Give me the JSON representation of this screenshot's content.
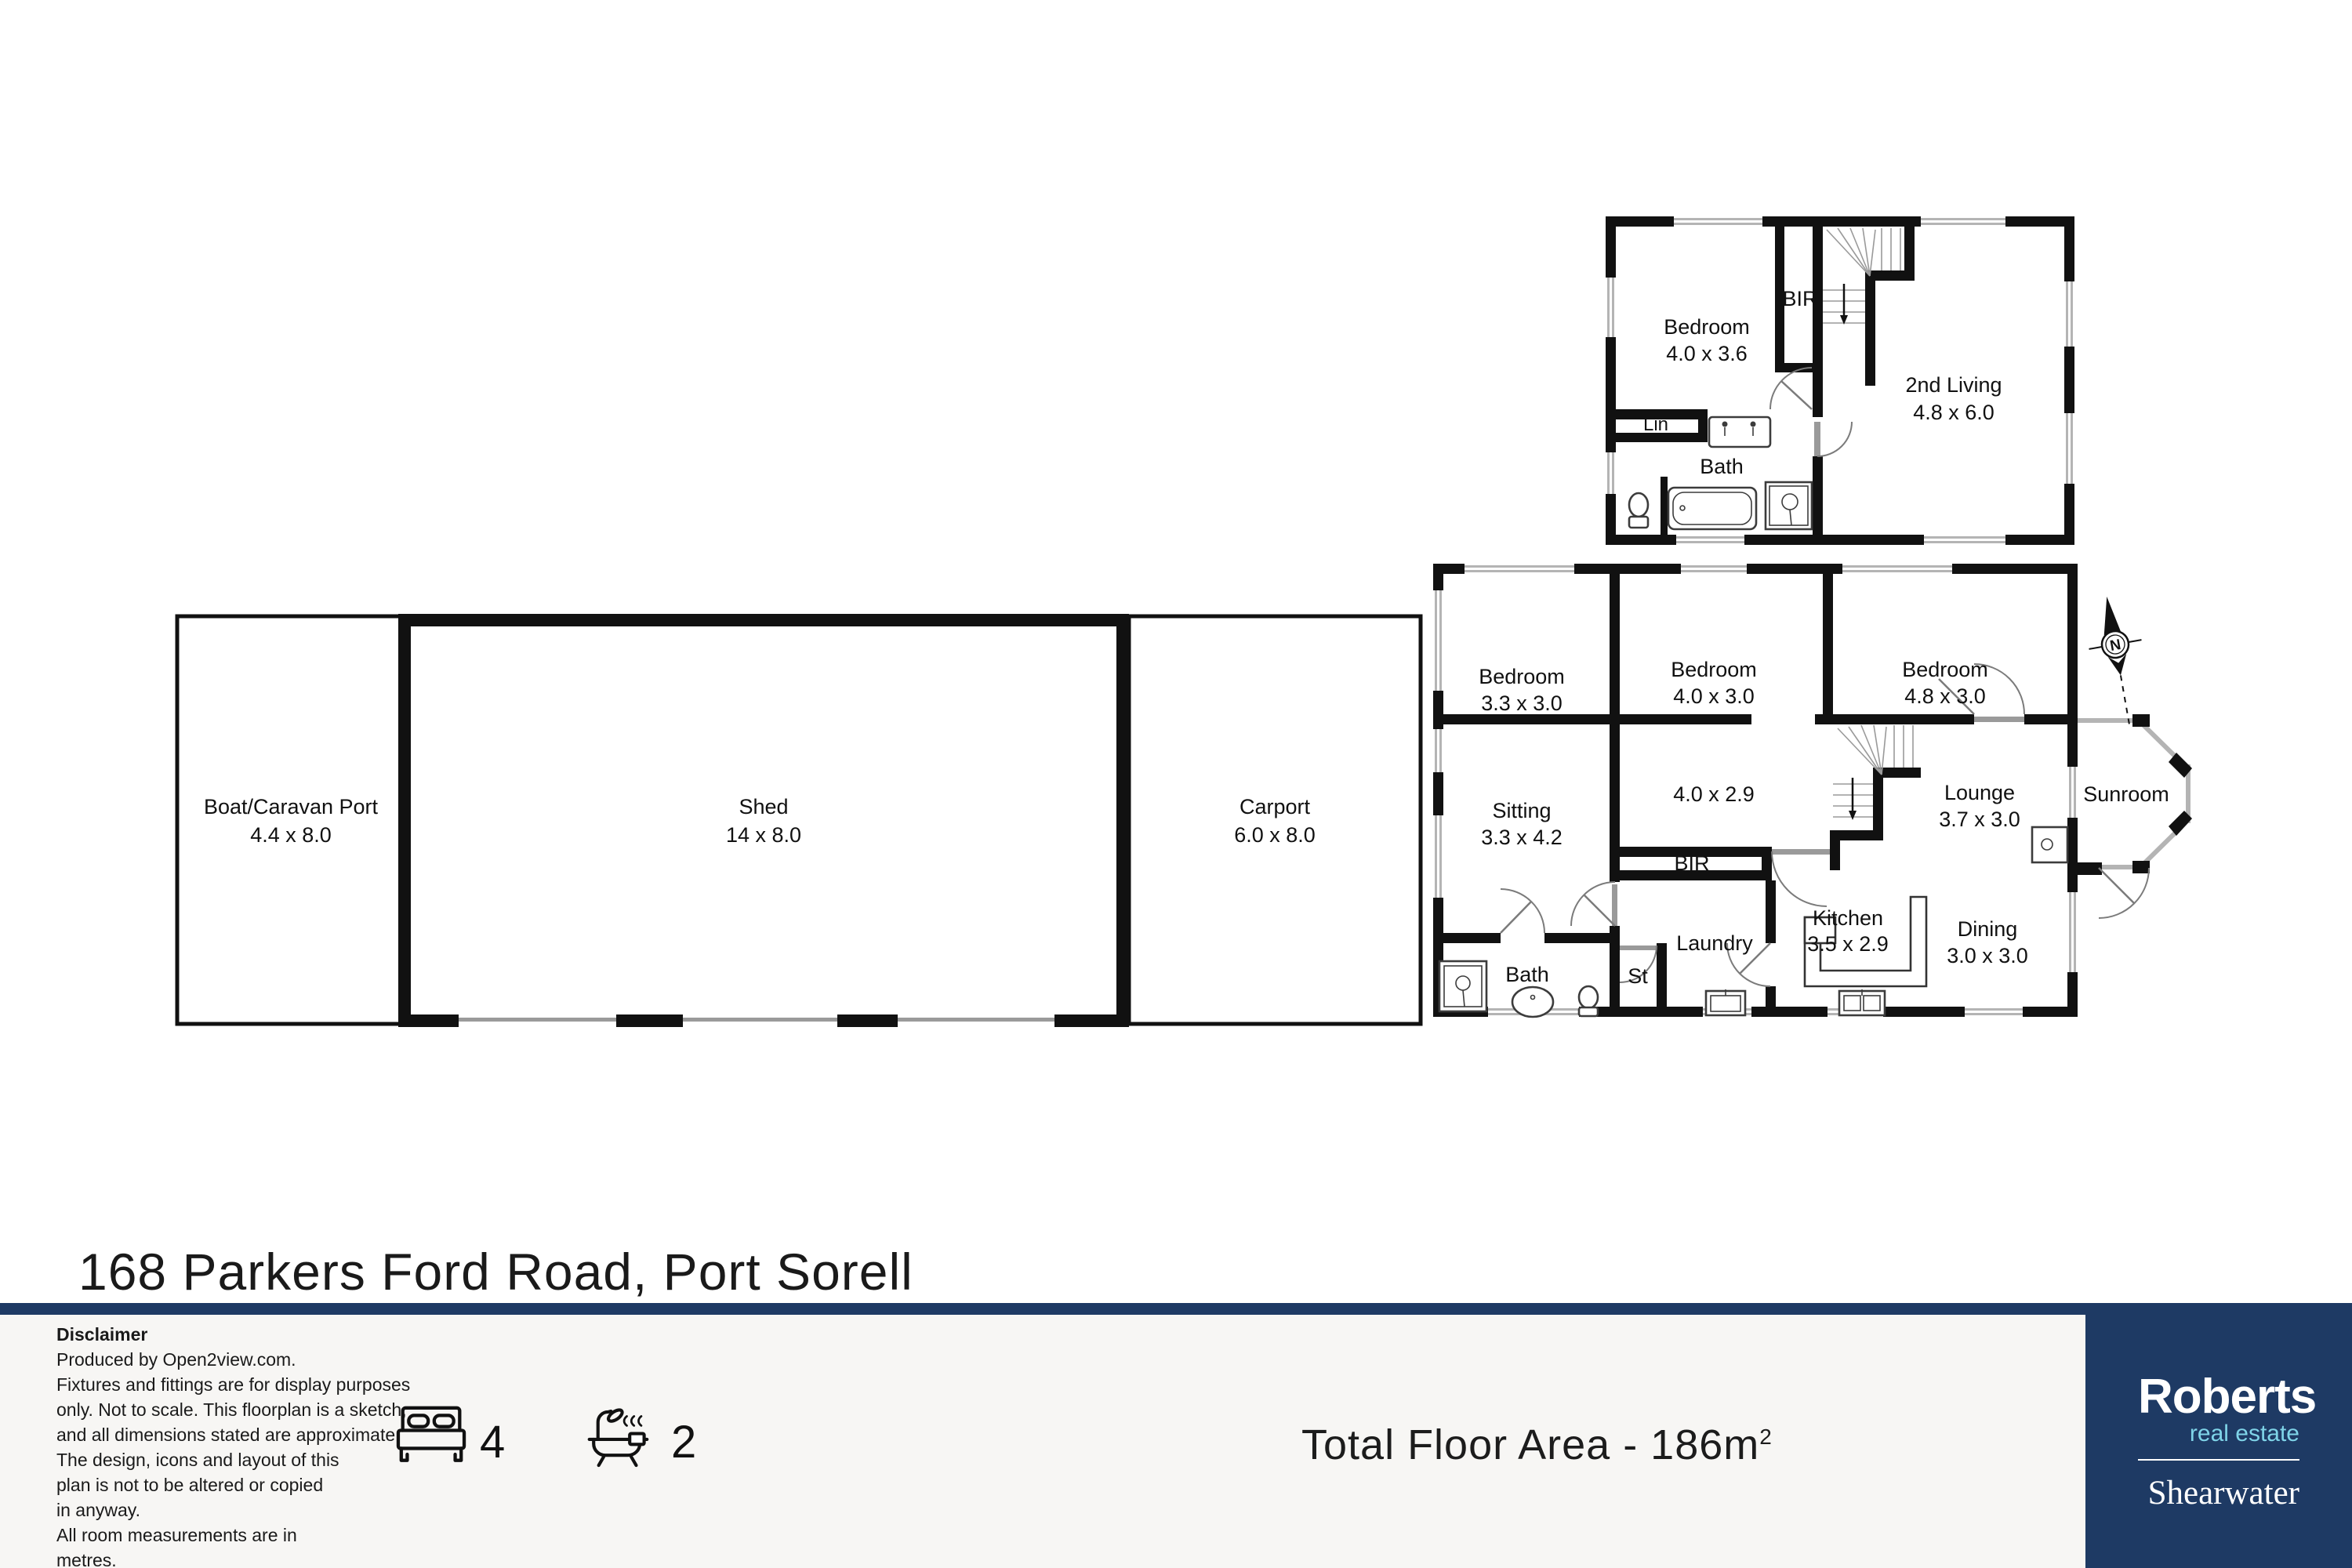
{
  "title": "168 Parkers Ford Road, Port Sorell",
  "plan": {
    "boat_name": "Boat/Caravan Port",
    "boat_dims": "4.4 x 8.0",
    "shed_name": "Shed",
    "shed_dims": "14 x 8.0",
    "carport_name": "Carport",
    "carport_dims": "6.0 x 8.0",
    "up_bedroom_name": "Bedroom",
    "up_bedroom_dims": "4.0 x 3.6",
    "up_bir": "BIR",
    "up_living_name": "2nd Living",
    "up_living_dims": "4.8 x 6.0",
    "up_lin": "Lin",
    "up_bath": "Bath",
    "g_bed1_name": "Bedroom",
    "g_bed1_dims": "3.3 x 3.0",
    "g_bed2_name": "Bedroom",
    "g_bed2_dims": "4.0 x 3.0",
    "g_bed3_name": "Bedroom",
    "g_bed3_dims": "4.8 x 3.0",
    "g_sitting_name": "Sitting",
    "g_sitting_dims": "3.3 x 4.2",
    "g_hall_dims": "4.0 x 2.9",
    "g_bir": "BIR",
    "g_lounge_name": "Lounge",
    "g_lounge_dims": "3.7 x 3.0",
    "g_sunroom": "Sunroom",
    "g_kitchen_name": "Kitchen",
    "g_kitchen_dims": "3.5 x 2.9",
    "g_dining_name": "Dining",
    "g_dining_dims": "3.0 x 3.0",
    "g_laundry": "Laundry",
    "g_bath": "Bath",
    "g_st": "St",
    "compass": "N"
  },
  "footer": {
    "disclaimer_heading": "Disclaimer",
    "disclaimer_lines": [
      "Produced by Open2view.com.",
      "Fixtures and fittings are for display purposes",
      "only. Not to scale. This floorplan is a sketch,",
      "and all dimensions stated are approximate.",
      "The design, icons and layout of this",
      "plan is not to be altered or copied",
      "in anyway.",
      "All room measurements are in",
      "metres."
    ],
    "beds": "4",
    "baths": "2",
    "total_area_label": "Total Floor Area - 186m",
    "total_area_sup": "2",
    "brand_name": "Roberts",
    "brand_tagline": "real estate",
    "brand_office": "Shearwater"
  },
  "colors": {
    "navy": "#1e3a64",
    "light_blue": "#7fd4e8",
    "footer_bg": "#f7f6f4"
  }
}
